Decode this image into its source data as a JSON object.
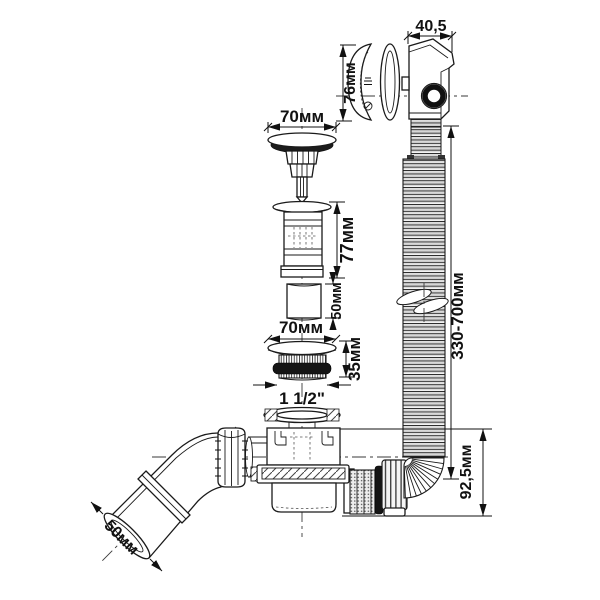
{
  "colors": {
    "background": "#ffffff",
    "line": "#1a1a1a",
    "dark_fill": "#1c1c1c",
    "gasket": "#151515"
  },
  "dimensions": {
    "overflow_width": "40,5",
    "overflow_cover_height": "76мм",
    "plug_cap_diameter": "70мм",
    "drain_body_height": "77мм",
    "adapter_height": "50мм",
    "flange_diameter": "70мм",
    "flange_thread_height": "35мм",
    "thread_size": "1 1/2\"",
    "hose_length_range": "330-700мм",
    "siphon_height": "92,5мм",
    "outlet_pipe_diameter": "50мм"
  }
}
